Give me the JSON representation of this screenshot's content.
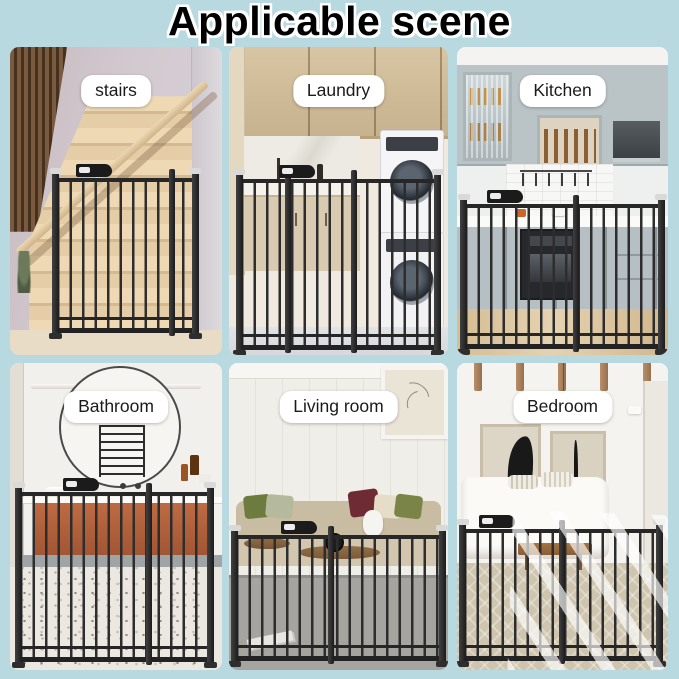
{
  "title": "Applicable scene",
  "colors": {
    "background": "#b9d9e1",
    "title_text": "#000000",
    "title_outline": "#ffffff",
    "label_background": "#ffffff",
    "label_text": "#1a1a1a",
    "gate_metal": "#262626",
    "bathroom_vanity": "#b0603c",
    "kitchen_cabinets": "#bac4c7",
    "laundry_cabinets": "#cdb999"
  },
  "panels": [
    {
      "id": "stairs",
      "label": "stairs"
    },
    {
      "id": "laundry",
      "label": "Laundry"
    },
    {
      "id": "kitchen",
      "label": "Kitchen"
    },
    {
      "id": "bathroom",
      "label": "Bathroom"
    },
    {
      "id": "living-room",
      "label": "Living room"
    },
    {
      "id": "bedroom",
      "label": "Bedroom"
    }
  ]
}
